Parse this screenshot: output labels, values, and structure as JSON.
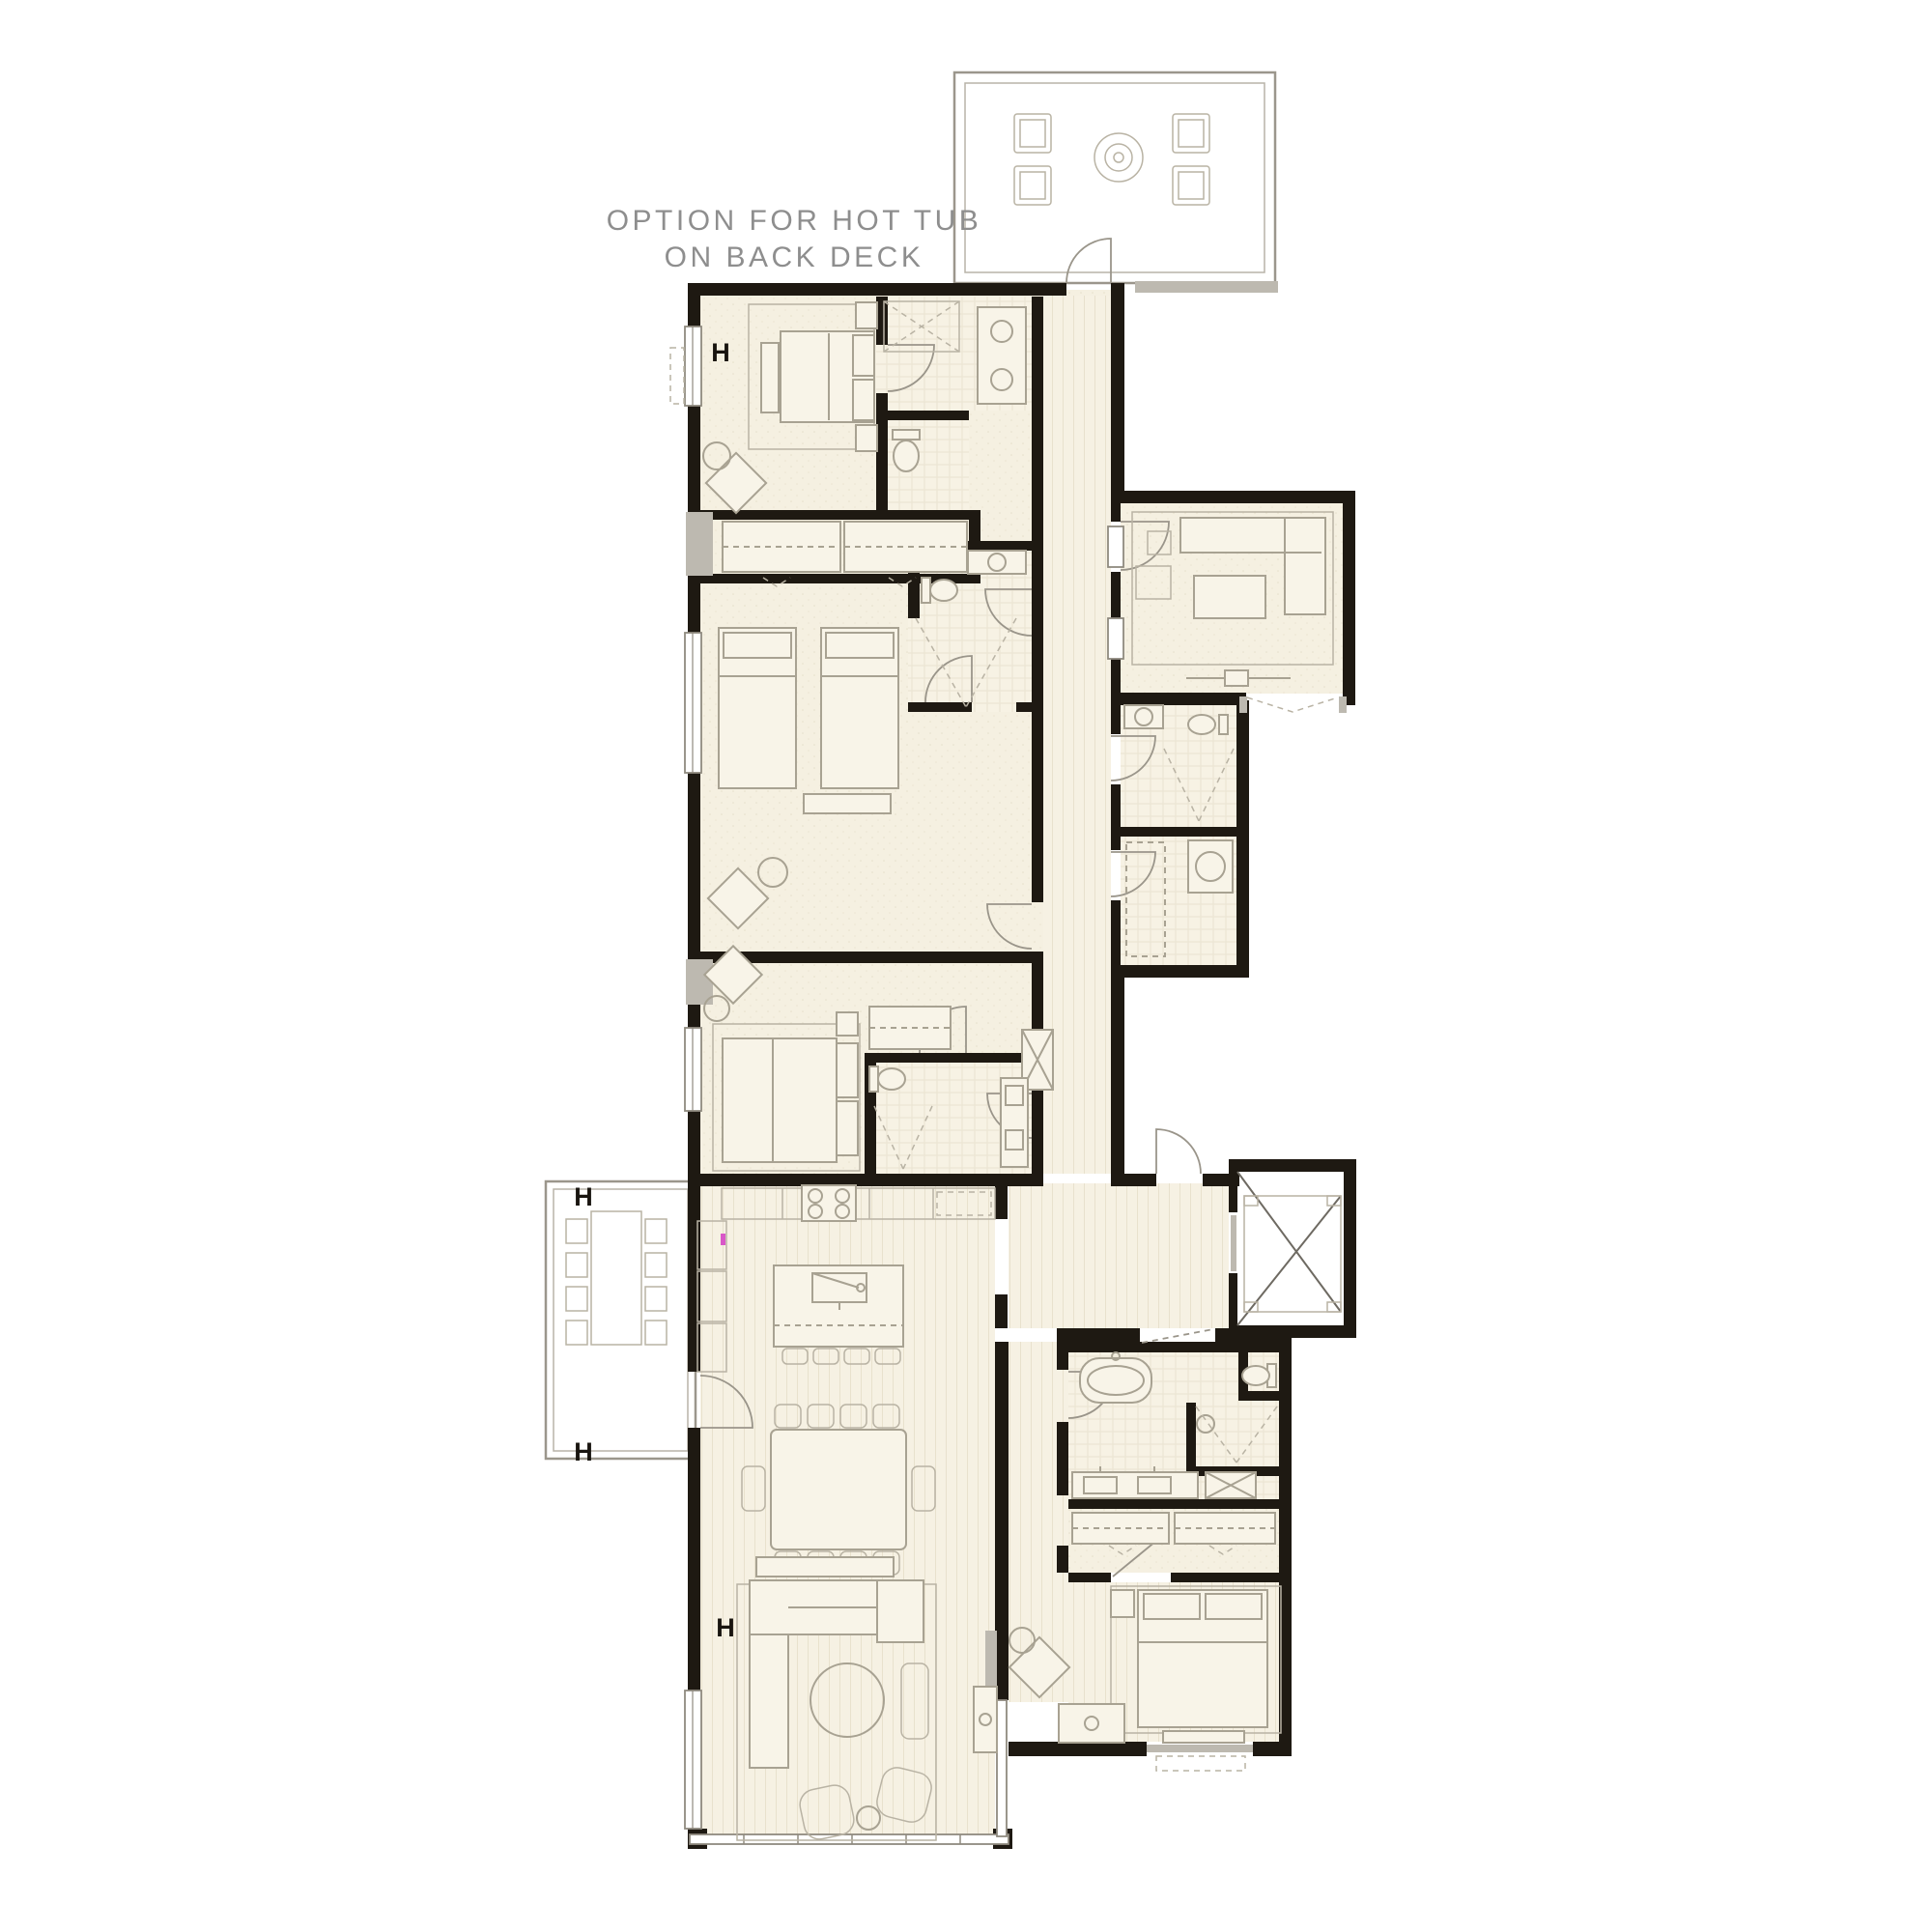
{
  "annotation": {
    "line1": "OPTION FOR HOT TUB",
    "line2": "ON BACK DECK"
  },
  "markers": {
    "label": "H",
    "count": 4,
    "locations": [
      "bedroom-1-west-wall",
      "side-deck-north-edge",
      "side-deck-south-edge",
      "living-room-west-wall"
    ]
  },
  "palette": {
    "background": "#ffffff",
    "walls": "#1e1912",
    "room_fill": "#f5f0e1",
    "wood_floor": "#f6f1e3",
    "wood_stripe": "#e8e1cd",
    "tile_line": "#eae3d1",
    "furniture_stroke": "#a8a292",
    "gray_accent": "#bdb9b0",
    "annotation_text": "#8e8e8e",
    "note_tick": "#d957c8"
  },
  "plan": {
    "decks": [
      {
        "name": "back-deck",
        "furniture": [
          "lounge-chair",
          "lounge-chair",
          "lounge-chair",
          "lounge-chair",
          "fire-pit",
          "hot-tub-option"
        ]
      },
      {
        "name": "side-deck",
        "furniture": [
          "outdoor-dining-table",
          "eight-chairs"
        ]
      }
    ],
    "rooms": [
      {
        "name": "bedroom-1",
        "furniture": [
          "queen-bed",
          "nightstands",
          "bench",
          "lounge-chair",
          "side-table",
          "closet-wardrobes",
          "window-seat"
        ]
      },
      {
        "name": "bath-1",
        "fixtures": [
          "shower",
          "toilet",
          "double-vanity"
        ]
      },
      {
        "name": "bunk-bedroom",
        "furniture": [
          "twin-bed",
          "twin-bed",
          "nightstand",
          "lounge-chair",
          "side-table"
        ]
      },
      {
        "name": "bath-2",
        "fixtures": [
          "shower",
          "toilet",
          "vanity"
        ]
      },
      {
        "name": "bedroom-3",
        "furniture": [
          "queen-bed",
          "nightstand",
          "lounge-chair",
          "side-table",
          "wardrobe",
          "window-seat"
        ]
      },
      {
        "name": "bath-3",
        "fixtures": [
          "shower",
          "toilet",
          "double-vanity"
        ]
      },
      {
        "name": "media-room",
        "furniture": [
          "sectional-sofa",
          "coffee-table",
          "armchair",
          "ottoman",
          "media-console",
          "rug"
        ]
      },
      {
        "name": "laundry-bath",
        "fixtures": [
          "vanity",
          "toilet",
          "shower"
        ]
      },
      {
        "name": "laundry-closet",
        "fixtures": [
          "washer-dryer",
          "shelving"
        ]
      },
      {
        "name": "hallway",
        "features": [
          "wood-plank-floor",
          "linen-closet"
        ]
      },
      {
        "name": "entry-hall",
        "features": [
          "entry-door",
          "elevator-access"
        ]
      },
      {
        "name": "elevator",
        "features": [
          "shaft-x-symbol"
        ]
      },
      {
        "name": "kitchen",
        "fixtures": [
          "range",
          "counter",
          "pantry",
          "tall-cabinets",
          "island-with-sink",
          "four-stools"
        ]
      },
      {
        "name": "dining",
        "furniture": [
          "dining-table",
          "ten-chairs"
        ]
      },
      {
        "name": "living-room",
        "furniture": [
          "sectional-sofa",
          "console",
          "round-coffee-table",
          "chaise",
          "two-swivel-chairs",
          "side-table",
          "rug"
        ]
      },
      {
        "name": "master-bath",
        "fixtures": [
          "freestanding-tub",
          "water-closet",
          "shower",
          "double-vanity",
          "linen-cabinet"
        ]
      },
      {
        "name": "master-closet",
        "fixtures": [
          "hanging-rods",
          "shelving"
        ]
      },
      {
        "name": "master-bedroom",
        "furniture": [
          "king-bed",
          "nightstand",
          "bench",
          "dresser",
          "lounge-chair",
          "side-table",
          "rug"
        ]
      }
    ]
  }
}
